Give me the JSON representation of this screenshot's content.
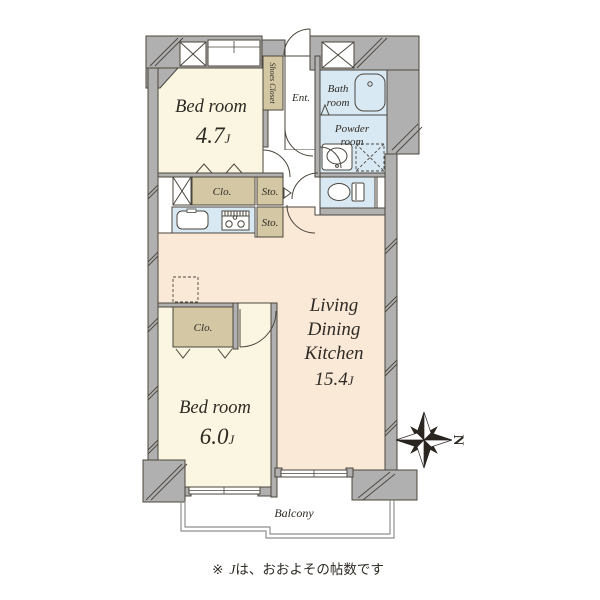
{
  "note": {
    "marker": "※",
    "unit": "J",
    "text": "は、おおよその帖数です"
  },
  "compass": {
    "north_label": "N"
  },
  "rooms": {
    "bedroom_1": {
      "name": "Bed room",
      "size": "4.7",
      "unit": "J"
    },
    "bedroom_2": {
      "name": "Bed room",
      "size": "6.0",
      "unit": "J"
    },
    "ldk": {
      "line1": "Living",
      "line2": "Dining",
      "line3": "Kitchen",
      "size": "15.4",
      "unit": "J"
    },
    "bath": {
      "line1": "Bath",
      "line2": "room"
    },
    "powder": {
      "line1": "Powder",
      "line2": "room"
    },
    "entrance": {
      "label": "Ent."
    },
    "shoes_closet": {
      "label": "Shoes Closet"
    },
    "closet_1": {
      "label": "Clo."
    },
    "closet_2": {
      "label": "Clo."
    },
    "storage_1": {
      "label": "Sto."
    },
    "storage_2": {
      "label": "Sto."
    },
    "balcony": {
      "label": "Balcony"
    }
  },
  "colors": {
    "wall": "#b0b0b0",
    "outline": "#4b463e",
    "bedroom": "#faf6e2",
    "ldk": "#fbe9d8",
    "wet": "#d9e9f4",
    "closet": "#d4c8a4",
    "balcony_line": "#8f8f8f",
    "text": "#2e2a24"
  }
}
